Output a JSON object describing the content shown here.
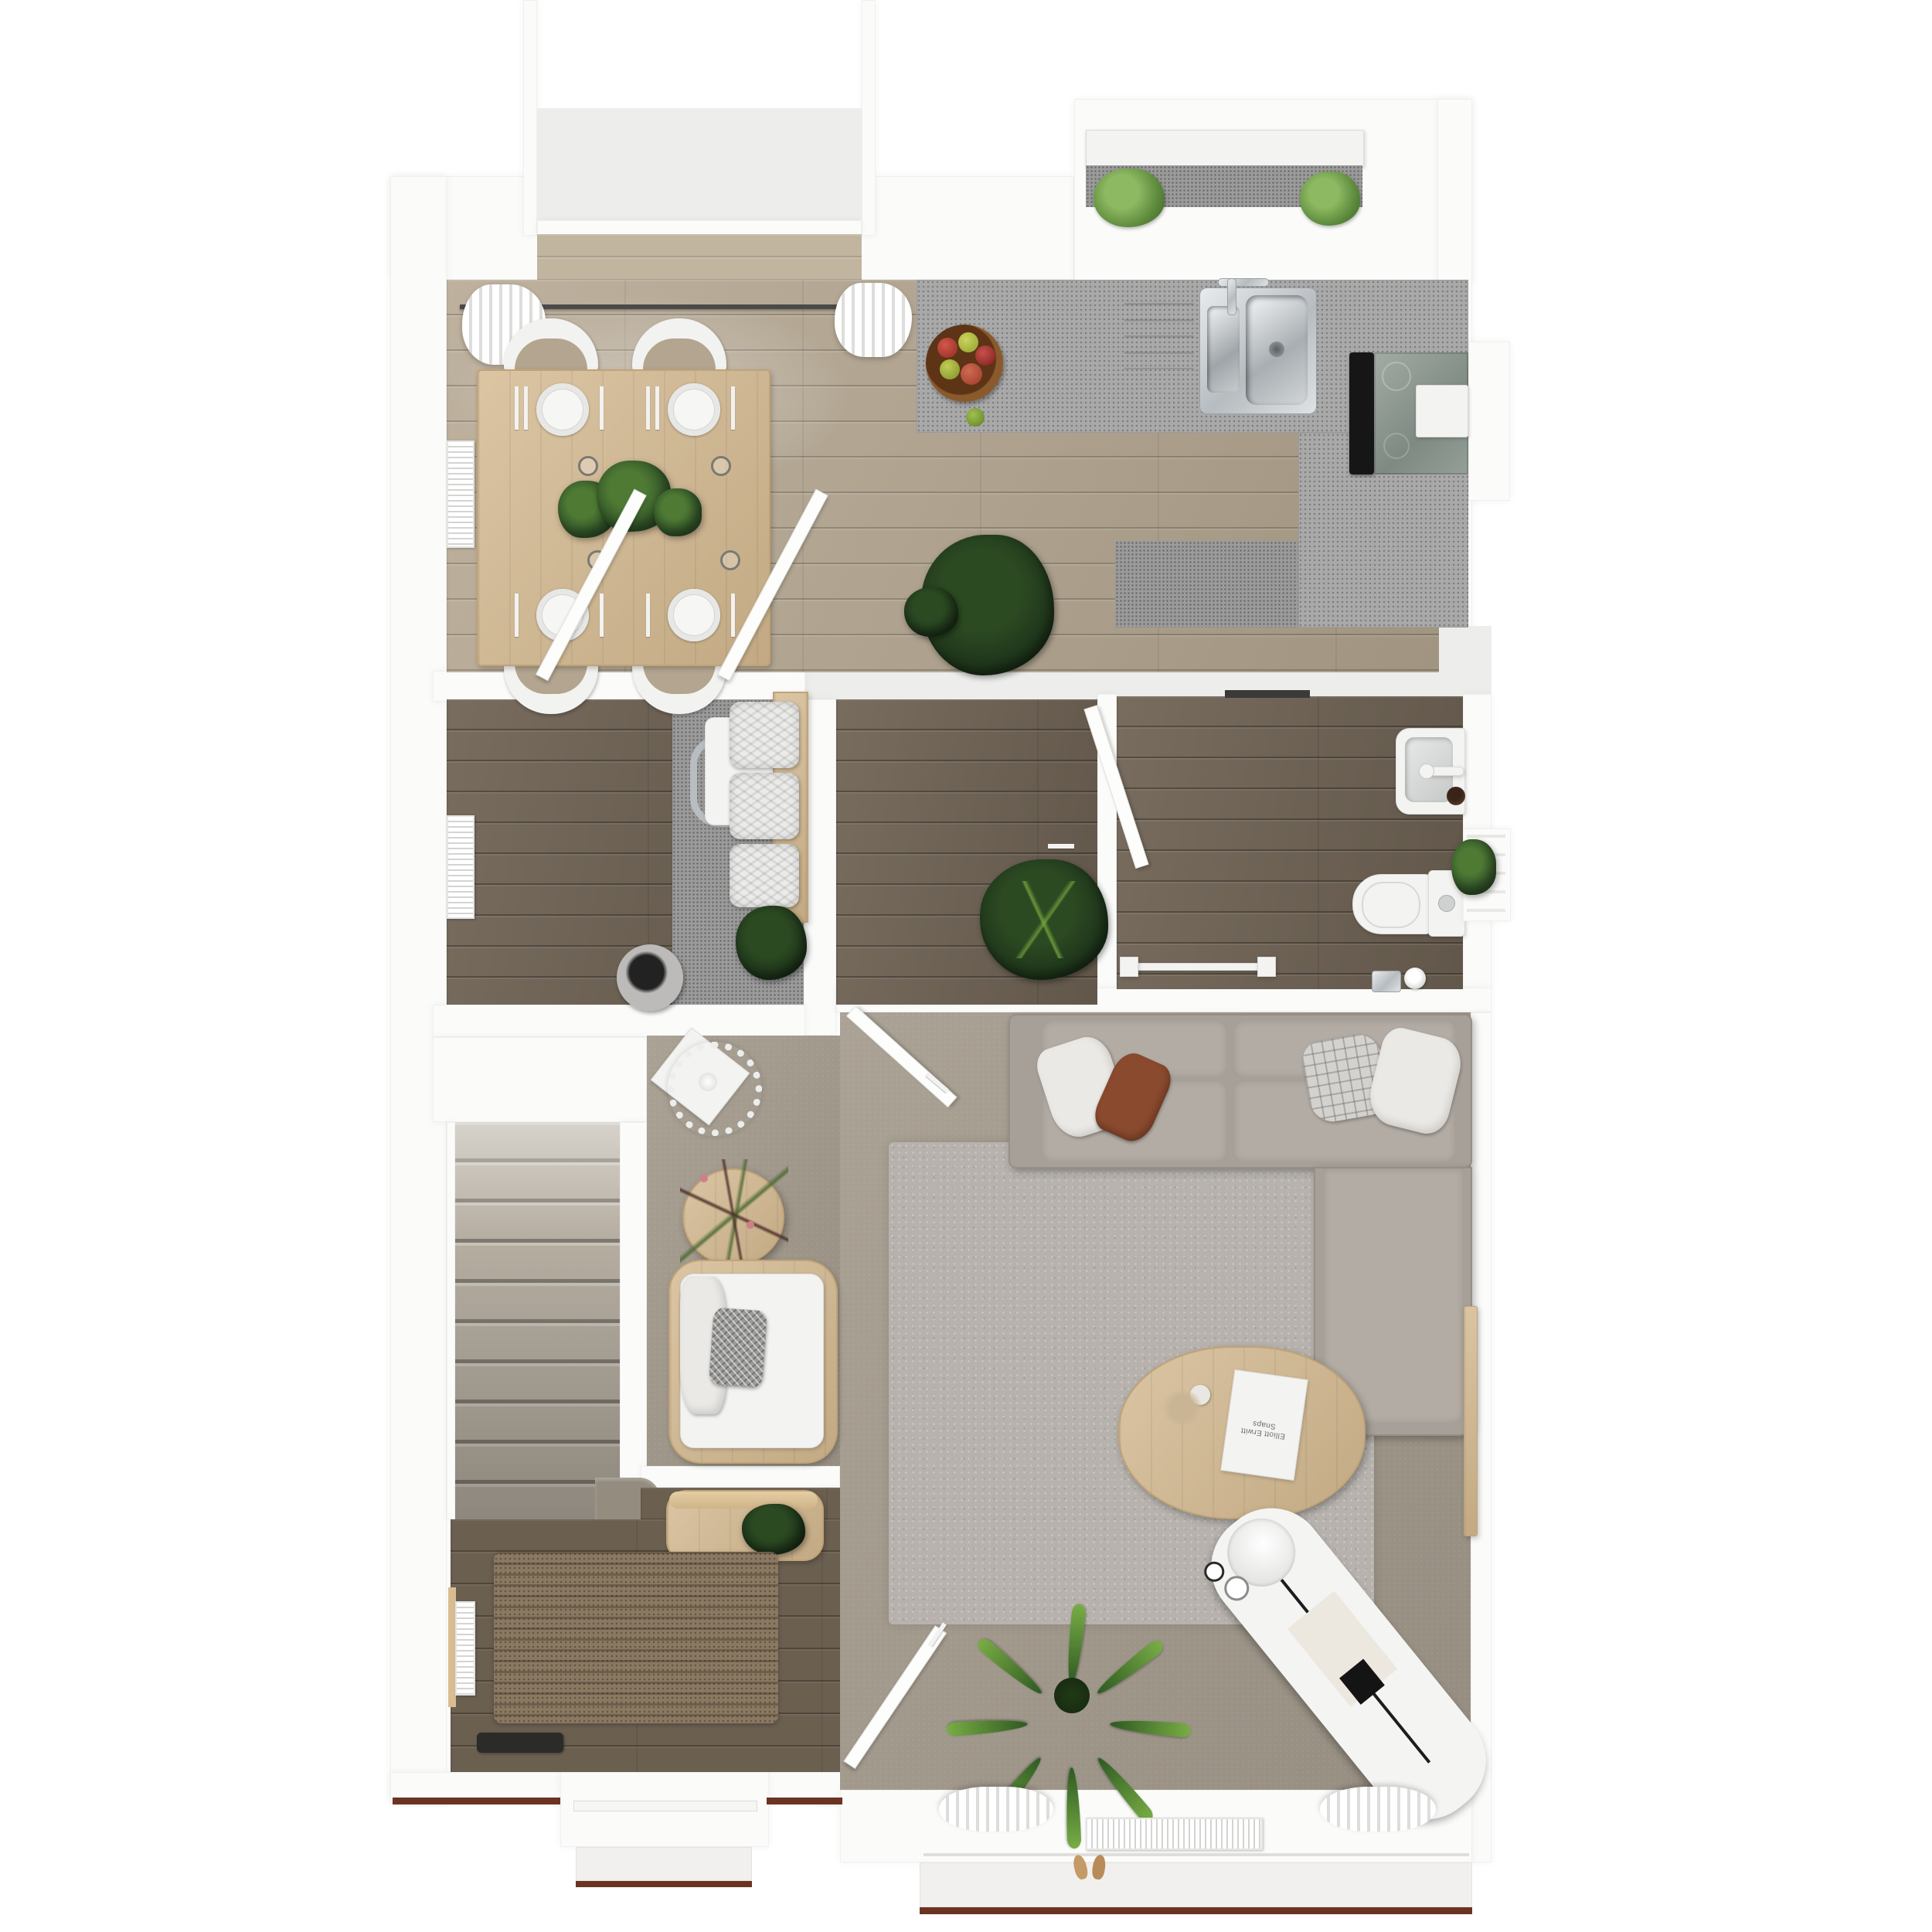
{
  "scene": {
    "title": "Ground-floor plan - photoreal top-down 3D render",
    "view": "top-down dollhouse",
    "background_color": "#ffffff"
  },
  "palette": {
    "wall_white": "#fbfbfa",
    "light_oak_floor": "#b3a58f",
    "dark_oak_floor": "#6f6354",
    "hall_floor": "#6b5f50",
    "counter_grey": "#a9a9a9",
    "living_floor_taupe": "#a49b8d",
    "rug_grey": "#b7b2ad",
    "jute_mat_brown": "#8b7861",
    "stair_carpet": "#b5ada0",
    "oak_furniture": "#d3b88f",
    "sofa_grey": "#a7a098",
    "pillow_rust": "#8a4a2e",
    "plant_green": "#4e7a34",
    "ground_edge_line": "#6b3322",
    "stainless_steel": "#c9cdd0"
  },
  "rooms": [
    {
      "id": "kitchen-dining",
      "name": "Kitchen / dining room",
      "floor": "light oak planks",
      "features": [
        "bay window",
        "curtain rail with two white curtains",
        "L-shaped speckled grey counter",
        "double stainless sink with tap",
        "black induction hob with oven unit",
        "wicker fruit bowl with apples",
        "oak dining table with four place settings",
        "four white chairs",
        "two potted plants on table",
        "radiator",
        "monstera floor plant",
        "two open doors"
      ]
    },
    {
      "id": "study",
      "name": "Study / inner room 1",
      "floor": "dark oak planks with grey nook",
      "features": [
        "chrome desk chair and white table",
        "oak shelf with three white storage baskets",
        "potted plant",
        "round grey fabric basket",
        "radiator"
      ]
    },
    {
      "id": "inner-room",
      "name": "Inner room 2",
      "floor": "dark oak planks",
      "features": [
        "open white door",
        "alocasia floor plant"
      ]
    },
    {
      "id": "bathroom",
      "name": "Bathroom / WC",
      "floor": "dark oak planks",
      "features": [
        "white washbasin with tap and soap dish",
        "toilet with cistern",
        "towel rail",
        "toilet-paper holder",
        "round bin",
        "side window with plant"
      ]
    },
    {
      "id": "living-room",
      "name": "Living room",
      "floor": "taupe floor",
      "features": [
        "grey corner sofa with chaise",
        "four scatter cushions",
        "large grey rug",
        "oval oak coffee table with magazine and vase",
        "round paper pendant lamp",
        "round oak side table with flowers",
        "oak-framed armchair with herringbone cushion",
        "white daybed lounger with tray and cups",
        "dracaena floor plant",
        "oak wall ledge",
        "window with curtains and radiator",
        "two open doors"
      ]
    },
    {
      "id": "staircase",
      "name": "Staircase",
      "floor": "beige carpet",
      "features": [
        "ten straight steps",
        "curved bottom step"
      ]
    },
    {
      "id": "hallway",
      "name": "Entrance hall",
      "floor": "dark oak planks",
      "features": [
        "woven jute doormat",
        "radiator with timber ledge",
        "black shoe tray",
        "oak console with plant",
        "front door with porch step",
        "pair of shoes by living-room window"
      ]
    }
  ],
  "living_room": {
    "magazine_title": "Elliott Erwitt Snaps"
  },
  "dining": {
    "chairs": 4,
    "place_settings": 4,
    "glasses": 4
  },
  "storage_baskets": 3,
  "open_doors": 5,
  "window_plants": 4
}
